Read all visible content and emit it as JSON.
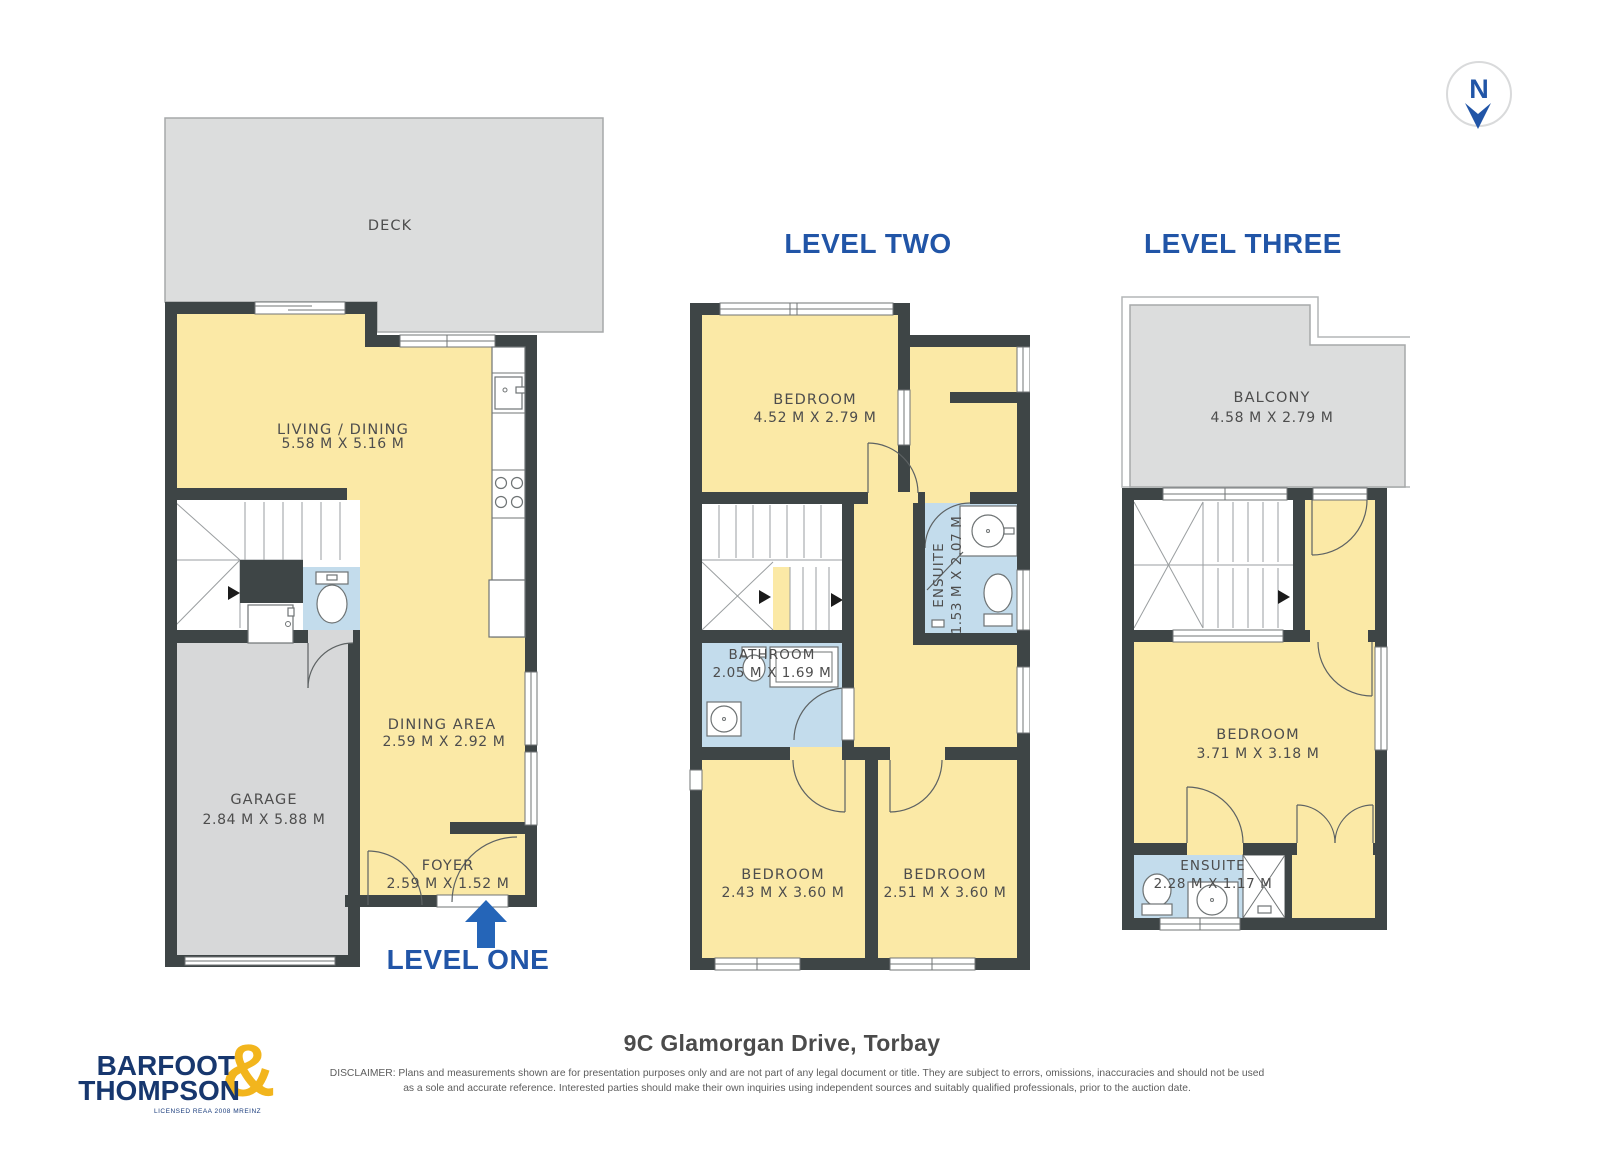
{
  "page": {
    "address": "9C Glamorgan Drive, Torbay",
    "disclaimer_line1": "DISCLAIMER: Plans and measurements shown are for presentation purposes only and are not part of any legal document or title. They are subject to errors, omissions, inaccuracies and should not be used",
    "disclaimer_line2": "as a sole and accurate reference. Interested parties should make their own inquiries using independent sources and suitably qualified professionals, prior to the auction date."
  },
  "compass": {
    "letter": "N"
  },
  "logo": {
    "line1": "BARFOOT",
    "line2": "THOMPSON",
    "ampersand": "&",
    "tagline": "LICENSED REAA 2008 MREINZ"
  },
  "levels": {
    "one": {
      "title": "LEVEL ONE",
      "deck": {
        "name": "DECK"
      },
      "living": {
        "name": "LIVING / DINING",
        "dims": "5.58 M X 5.16 M"
      },
      "dining": {
        "name": "DINING AREA",
        "dims": "2.59 M X 2.92 M"
      },
      "garage": {
        "name": "GARAGE",
        "dims": "2.84 M X 5.88 M"
      },
      "foyer": {
        "name": "FOYER",
        "dims": "2.59 M X 1.52 M"
      }
    },
    "two": {
      "title": "LEVEL TWO",
      "bedroom1": {
        "name": "BEDROOM",
        "dims": "4.52 M X 2.79 M"
      },
      "ensuite": {
        "name": "ENSUITE",
        "dims": "1.53 M X 2.07 M"
      },
      "bathroom": {
        "name": "BATHROOM",
        "dims": "2.05 M X 1.69 M"
      },
      "bedroom2": {
        "name": "BEDROOM",
        "dims": "2.43 M X 3.60 M"
      },
      "bedroom3": {
        "name": "BEDROOM",
        "dims": "2.51 M X 3.60 M"
      }
    },
    "three": {
      "title": "LEVEL THREE",
      "balcony": {
        "name": "BALCONY",
        "dims": "4.58 M X 2.79 M"
      },
      "bedroom": {
        "name": "BEDROOM",
        "dims": "3.71 M X 3.18 M"
      },
      "ensuite": {
        "name": "ENSUITE",
        "dims": "2.28 M X 1.17 M"
      }
    }
  },
  "colors": {
    "room_fill": "#fbe9a6",
    "wet_room_fill": "#c3dcec",
    "outdoor_fill": "#dcdddd",
    "garage_fill": "#d7d8d9",
    "wall": "#3e4546",
    "title_blue": "#2155a7",
    "arrow_blue": "#2565b8",
    "logo_navy": "#17376e",
    "logo_gold": "#f2b51d"
  }
}
